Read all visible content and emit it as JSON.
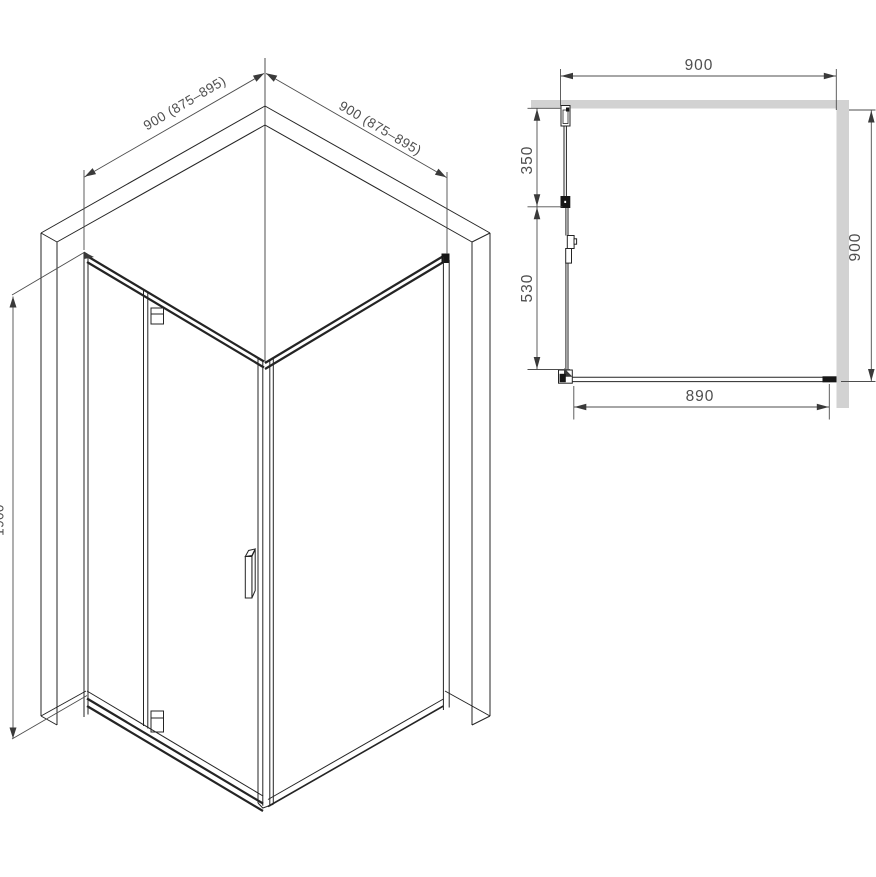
{
  "isometric_view": {
    "dim_top_left": "900 (875–895)",
    "dim_top_right": "900 (875–895)",
    "dim_height": "1900"
  },
  "plan_view": {
    "dim_width_top": "900",
    "dim_depth_right": "900",
    "dim_width_bottom": "890",
    "dim_wall_to_hinge": "350",
    "dim_hinge_to_front": "530"
  },
  "colors": {
    "line": "#242424",
    "dimension": "#4d4d4d",
    "wall_fill": "#d2d2d2",
    "background": "#ffffff"
  }
}
